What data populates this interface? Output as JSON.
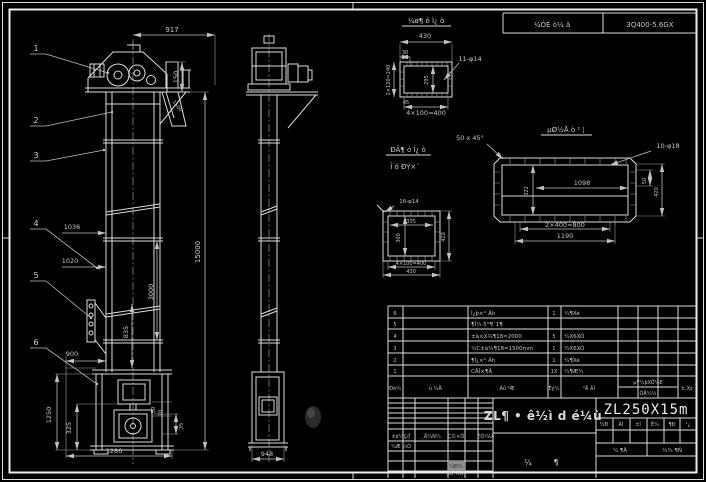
{
  "colors": {
    "bg": "#000000",
    "line": "#dcdcdc",
    "dim_text": "#c6c6c6",
    "gray_cell": "#8f8f8f"
  },
  "header_strip": {
    "process_cell": "¼ÓÈ ò¼ ä",
    "model_cell": "3Q400-5.6GX"
  },
  "balloons": [
    "1",
    "2",
    "3",
    "4",
    "5",
    "6"
  ],
  "front_view": {
    "dim_917": "917",
    "dim_150": "150",
    "dim_1500": "1500",
    "dim_15000": "15000",
    "dim_1036": "1036",
    "dim_1020": "1020",
    "dim_3000": "3000",
    "dim_835": "835",
    "dim_900": "900",
    "dim_1250": "1250",
    "dim_325": "325",
    "dim_1286": "1286",
    "dim_50": "50",
    "dim_70": "70",
    "dim_35": "35"
  },
  "side_view": {
    "dim_948": "948"
  },
  "detail_a": {
    "title": "¼ø¶ ó Ì¿ ò",
    "dim_430": "430",
    "dim_30": "30",
    "dim_240": "2×120=240",
    "dim_295": "295",
    "holes": "11-φ14",
    "dim_45": "45",
    "dim_400": "4×100=400"
  },
  "mid_note": {
    "line1": "ÐÂ¶ ó Ì¿ ò",
    "line2": "Î ó ÐÝ×¨",
    "chamfer": "50 x 45°"
  },
  "detail_b": {
    "title": "µØ½Å ò ¹ ¦",
    "holes": "10-φ18",
    "dim_1098": "1098",
    "dim_322": "322",
    "dim_800": "2×400=800",
    "dim_1190": "1190",
    "dim_50": "50",
    "dim_420": "420"
  },
  "detail_c": {
    "holes": "16-φ14",
    "dim_335": "335",
    "dim_300": "300",
    "dim_420": "420",
    "dim_400": "4×100=400",
    "dim_430": "430"
  },
  "bom": {
    "headers": {
      "no": "Ðò¼",
      "code": "´ú ¼Å",
      "name": "Ãû ³Æ",
      "qty": "Êý¼",
      "material": "²Ä ÁÏ",
      "unit_weight": "µ¥¼þXÖ¼E",
      "total_weight": "ÓÅ¼¼",
      "remark": "±,X¢"
    },
    "rows": [
      {
        "no": "6",
        "name": "Í¿þ×° Àh",
        "qty": "1",
        "material": "¼¶Xè"
      },
      {
        "no": "5",
        "name": "¶Î¼·5°¶´1¶",
        "qty": "",
        "material": ""
      },
      {
        "no": "4",
        "name": "±ä×X¾¶18=2000",
        "qty": "5",
        "material": "¼X6XÓ"
      },
      {
        "no": "3",
        "name": "¼C±ä¾¶18=1500mm",
        "qty": "1",
        "material": "¼X6XÓ"
      },
      {
        "no": "2",
        "name": "¶Î¿×° Àh",
        "qty": "1",
        "material": "¼¶Xè"
      },
      {
        "no": "1",
        "name": "CÅÎ×¶Å",
        "qty": "1X",
        "material": "¼¶Æ¼"
      }
    ]
  },
  "title_block": {
    "drawing_title": "ZL¶ • ê½ì d é¼ù",
    "model": "ZL250X15m",
    "sig_headers": [
      "±ê¼Ç(Î",
      "¸Ä¼Ñ¼",
      "Ç©×Ö",
      "ÈÕ¼Ú"
    ],
    "sig_row2": "¼Æ ¼Ò",
    "sig_row3": "Éó ¼Ñ",
    "sig_gray": "¼Ð¼",
    "stage_cells": [
      "¼Ð",
      "ÀÌ",
      "±Ì",
      "Ê¼",
      "¶Ð",
      "¹¿"
    ],
    "count_left": "¼ ¶Å",
    "count_right": "¼¼ ¶Ñ",
    "sheet_left": "¼",
    "sheet_right": "¶"
  }
}
